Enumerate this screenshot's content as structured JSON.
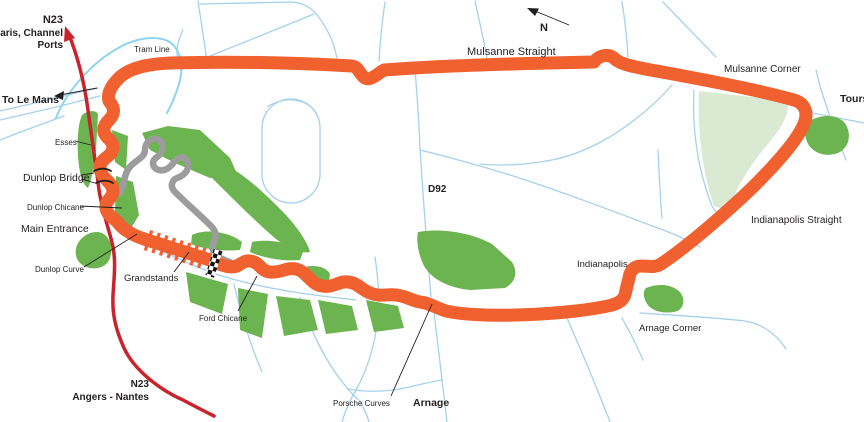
{
  "map_title": "Circuit de la Sarthe - Le Mans track map",
  "labels": {
    "n23_north": "N23",
    "paris_channel": "Paris, Channel",
    "ports": "Ports",
    "to_le_mans": "To Le Mans",
    "tram_line": "Tram Line",
    "mulsanne_straight": "Mulsanne Straight",
    "compass_n": "N",
    "mulsanne_corner": "Mulsanne Corner",
    "tours": "Tours",
    "esses": "Esses",
    "dunlop_bridge": "Dunlop Bridge",
    "dunlop_chicane": "Dunlop Chicane",
    "main_entrance": "Main Entrance",
    "dunlop_curve": "Dunlop Curve",
    "grandstands": "Grandstands",
    "d92": "D92",
    "indianapolis": "Indianapolis",
    "indianapolis_straight": "Indianapolis Straight",
    "ford_chicane": "Ford Chicane",
    "arnage_corner": "Arnage Corner",
    "porsche_curves": "Porsche Curves",
    "arnage": "Arnage",
    "n23_south": "N23",
    "angers_nantes": "Angers - Nantes"
  },
  "icons": {
    "compass": "north-arrow",
    "to_le_mans": "left-arrow",
    "n23": "highway-direction-arrow",
    "start_finish": "checkered-line"
  },
  "colors": {
    "track_orange": "#F1602F",
    "bugatti_gray": "#9C9C9C",
    "green": "#6CB450",
    "pale_green": "#DAE9D2",
    "road_blue": "#A5D1EC",
    "tram_blue": "#8DD4F0",
    "highway_red": "#C9232C",
    "cyan_text": "#29ABE2",
    "blue_text": "#1C75BC",
    "black_text": "#231F20",
    "background": "#FFFFFF"
  }
}
